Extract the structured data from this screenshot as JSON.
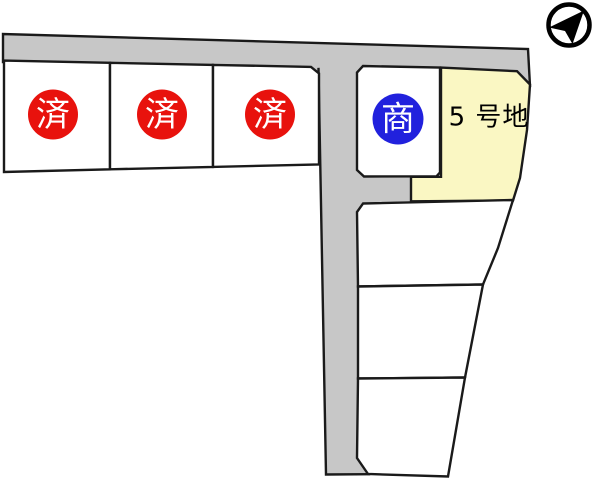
{
  "colors": {
    "road": "#c7c7c7",
    "plot_fill": "#ffffff",
    "outline": "#1a1a1a",
    "sold_badge": "#e8120d",
    "negotiation_badge": "#2121dd",
    "highlight_plot": "#faf7c3",
    "badge_text": "#ffffff",
    "plot_label_text": "#000000",
    "compass": "#000000"
  },
  "badges": {
    "sold": [
      {
        "label": "済"
      },
      {
        "label": "済"
      },
      {
        "label": "済"
      }
    ],
    "negotiation": {
      "label": "商"
    }
  },
  "plots": {
    "plot5": {
      "label": "5 号地"
    }
  },
  "icons": {
    "compass": "north-arrow"
  }
}
